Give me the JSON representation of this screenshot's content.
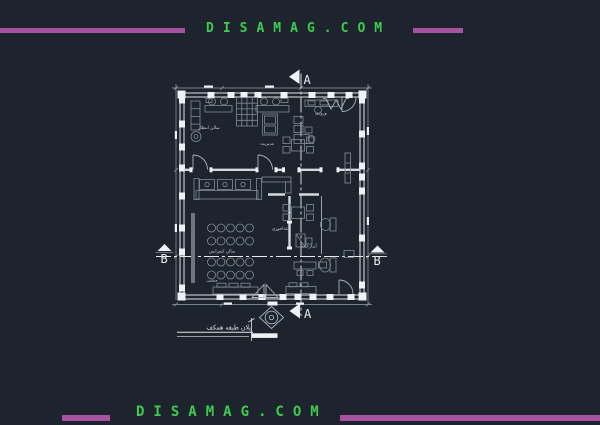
{
  "page": {
    "background": "#1e242d"
  },
  "banners": {
    "top": {
      "text": "DISAMAG.COM",
      "text_color": "#3ecb50",
      "bar_color": "#a6549f"
    },
    "bottom": {
      "text": "DISAMAG.COM",
      "text_color": "#3ecb50",
      "bar_color": "#a6549f"
    }
  },
  "plan": {
    "colors": {
      "wall": "#dde3e9",
      "furniture": "#838b95",
      "dimension": "#98a0aa",
      "marker": "#eef2f6"
    },
    "markers": {
      "top": "A",
      "bottom": "A",
      "left": "B",
      "right": "B"
    },
    "room_labels": [
      {
        "id": "waiting-hall",
        "text": "سالن انتظار"
      },
      {
        "id": "management",
        "text": "مدیریت"
      },
      {
        "id": "entrance",
        "text": "ورودی"
      },
      {
        "id": "conference-hall",
        "text": "سالن کنفرانس"
      },
      {
        "id": "dining",
        "text": "غذاخوری"
      },
      {
        "id": "pantry",
        "text": "آبدارخانه"
      },
      {
        "id": "secretary",
        "text": "منشی"
      }
    ],
    "caption": "پلان طبقه همکف"
  }
}
